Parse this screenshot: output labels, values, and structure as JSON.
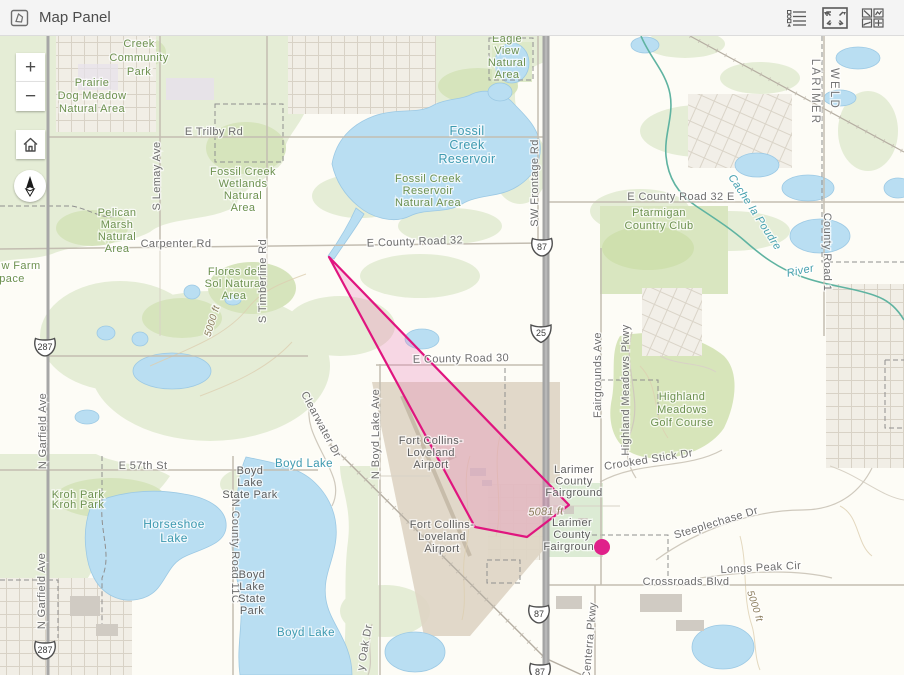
{
  "header": {
    "title": "Map Panel",
    "icons": {
      "panel": "map-panel-icon",
      "legend": "legend-icon",
      "fullscreen": "fullscreen-icon",
      "basemap": "basemap-gallery-icon"
    }
  },
  "controls": {
    "zoom_in": "+",
    "zoom_out": "−",
    "home": "home-icon",
    "compass": "compass-icon"
  },
  "map": {
    "overlays": {
      "polygon": {
        "points": "329,221 475,491 527,501 569,469",
        "stroke": "#e0157f",
        "fill": "rgba(235,130,187,0.30)"
      },
      "marker": {
        "x": 602,
        "y": 511,
        "r": 8,
        "color": "#e0218a"
      }
    },
    "shields": [
      {
        "type": "us",
        "text": "287",
        "x": 45,
        "y": 311
      },
      {
        "type": "us",
        "text": "287",
        "x": 45,
        "y": 614
      },
      {
        "type": "us",
        "text": "87",
        "x": 542,
        "y": 211
      },
      {
        "type": "interstate",
        "text": "25",
        "x": 541,
        "y": 297
      },
      {
        "type": "us",
        "text": "87",
        "x": 539,
        "y": 578
      },
      {
        "type": "us",
        "text": "87",
        "x": 540,
        "y": 636
      }
    ],
    "labels": [
      {
        "t": "Creek\nCommunity\nPark",
        "x": 139,
        "y": 11,
        "c": "park",
        "lh": 14
      },
      {
        "t": "Prairie\nDog Meadow\nNatural Area",
        "x": 92,
        "y": 50,
        "c": "park",
        "lh": 13
      },
      {
        "t": "E Trilby Rd",
        "x": 214,
        "y": 99,
        "c": "road"
      },
      {
        "t": "S Lemay Ave",
        "x": 160,
        "y": 140,
        "c": "road",
        "r": -90
      },
      {
        "t": "Fossil Creek\nWetlands\nNatural\nArea",
        "x": 243,
        "y": 139,
        "c": "park",
        "lh": 12
      },
      {
        "t": "Pelican\nMarsh\nNatural\nArea",
        "x": 117,
        "y": 180,
        "c": "park",
        "lh": 12
      },
      {
        "t": "Carpenter Rd",
        "x": 176,
        "y": 211,
        "c": "road"
      },
      {
        "t": "w Farm",
        "x": 21,
        "y": 233,
        "c": "park"
      },
      {
        "t": "pace",
        "x": 12,
        "y": 246,
        "c": "park"
      },
      {
        "t": "Flores del\nSol Natural\nArea",
        "x": 234,
        "y": 239,
        "c": "park",
        "lh": 12
      },
      {
        "t": "S Timberline Rd",
        "x": 266,
        "y": 245,
        "c": "road",
        "r": -90
      },
      {
        "t": "5000 ft",
        "x": 215,
        "y": 286,
        "c": "elev",
        "r": -73
      },
      {
        "t": "Eagle\nView\nNatural\nArea",
        "x": 507,
        "y": 6,
        "c": "park",
        "lh": 12
      },
      {
        "t": "Fossil\nCreek\nReservoir",
        "x": 467,
        "y": 99,
        "c": "water",
        "lh": 14,
        "fs": 12.5
      },
      {
        "t": "Fossil Creek\nReservoir\nNatural Area",
        "x": 428,
        "y": 146,
        "c": "park",
        "lh": 12
      },
      {
        "t": "SW Frontage Rd",
        "x": 538,
        "y": 147,
        "c": "road",
        "r": -90
      },
      {
        "t": "E County Road 32",
        "x": 415,
        "y": 209,
        "c": "road",
        "r": -2
      },
      {
        "t": "E County Road 32 E",
        "x": 681,
        "y": 164,
        "c": "road"
      },
      {
        "t": "Ptarmigan\nCountry Club",
        "x": 659,
        "y": 180,
        "c": "park",
        "lh": 13
      },
      {
        "t": "LARIMER",
        "x": 812,
        "y": 56,
        "c": "bound",
        "r": 90
      },
      {
        "t": "WELD",
        "x": 831,
        "y": 53,
        "c": "bound",
        "r": 90
      },
      {
        "t": "County Road 1",
        "x": 824,
        "y": 216,
        "c": "road",
        "r": 90
      },
      {
        "t": "Cache la Poudre",
        "x": 752,
        "y": 178,
        "c": "wateri",
        "r": 57
      },
      {
        "t": "River",
        "x": 801,
        "y": 238,
        "c": "wateri",
        "r": -12
      },
      {
        "t": "E County Road 30",
        "x": 461,
        "y": 326,
        "c": "road",
        "r": -1
      },
      {
        "t": "Fairgrounds Ave",
        "x": 601,
        "y": 339,
        "c": "road",
        "r": -90
      },
      {
        "t": "Highland Meadows Pkwy",
        "x": 629,
        "y": 354,
        "c": "road",
        "r": -90
      },
      {
        "t": "Highland\nMeadows\nGolf Course",
        "x": 682,
        "y": 364,
        "c": "park",
        "lh": 13
      },
      {
        "t": "Crooked Stick Dr",
        "x": 649,
        "y": 427,
        "c": "road",
        "r": -9
      },
      {
        "t": "N Boyd Lake Ave",
        "x": 379,
        "y": 398,
        "c": "road",
        "r": -90
      },
      {
        "t": "Clearwater Dr",
        "x": 318,
        "y": 390,
        "c": "road",
        "r": 62
      },
      {
        "t": "Boyd Lake",
        "x": 304,
        "y": 431,
        "c": "water"
      },
      {
        "t": "E 57th St",
        "x": 143,
        "y": 433,
        "c": "road"
      },
      {
        "t": "Boyd\nLake\nState Park",
        "x": 250,
        "y": 438,
        "c": "poi",
        "lh": 12
      },
      {
        "t": "Kroh Park",
        "x": 78,
        "y": 462,
        "c": "park"
      },
      {
        "t": "Kroh Park",
        "x": 78,
        "y": 472,
        "c": "park"
      },
      {
        "t": "Horseshoe\nLake",
        "x": 174,
        "y": 492,
        "c": "water",
        "lh": 14,
        "fs": 12
      },
      {
        "t": "N County Road 11C",
        "x": 232,
        "y": 515,
        "c": "road",
        "r": 90
      },
      {
        "t": "N Garfield Ave",
        "x": 46,
        "y": 395,
        "c": "road",
        "r": -90
      },
      {
        "t": "N Garfield Ave",
        "x": 45,
        "y": 555,
        "c": "road",
        "r": -90
      },
      {
        "t": "Fort Collins-\nLoveland\nAirport",
        "x": 431,
        "y": 408,
        "c": "poi",
        "lh": 12
      },
      {
        "t": "Fort Collins-\nLoveland\nAirport",
        "x": 442,
        "y": 492,
        "c": "poi",
        "lh": 12
      },
      {
        "t": "Larimer\nCounty\nFairground",
        "x": 574,
        "y": 437,
        "c": "poi",
        "lh": 11.5
      },
      {
        "t": "Larimer\nCounty\nFairground",
        "x": 572,
        "y": 490,
        "c": "poi",
        "lh": 12
      },
      {
        "t": "5081 ft",
        "x": 546,
        "y": 479,
        "c": "elev",
        "r": -2,
        "fs": 11
      },
      {
        "t": "Steeplechase Dr",
        "x": 717,
        "y": 490,
        "c": "road",
        "r": -17
      },
      {
        "t": "Longs Peak Cir",
        "x": 761,
        "y": 535,
        "c": "road",
        "r": -3
      },
      {
        "t": "Crossroads Blvd",
        "x": 686,
        "y": 549,
        "c": "road"
      },
      {
        "t": "5000 ft",
        "x": 752,
        "y": 571,
        "c": "elev",
        "r": 72
      },
      {
        "t": "Centerra Pkwy",
        "x": 593,
        "y": 605,
        "c": "road",
        "r": -85
      },
      {
        "t": "y Oak Dr",
        "x": 368,
        "y": 612,
        "c": "road",
        "r": -80
      },
      {
        "t": "Boyd Lake",
        "x": 306,
        "y": 600,
        "c": "water"
      },
      {
        "t": "Boyd\nLake\nState\nPark",
        "x": 252,
        "y": 542,
        "c": "poi",
        "lh": 12
      }
    ]
  }
}
